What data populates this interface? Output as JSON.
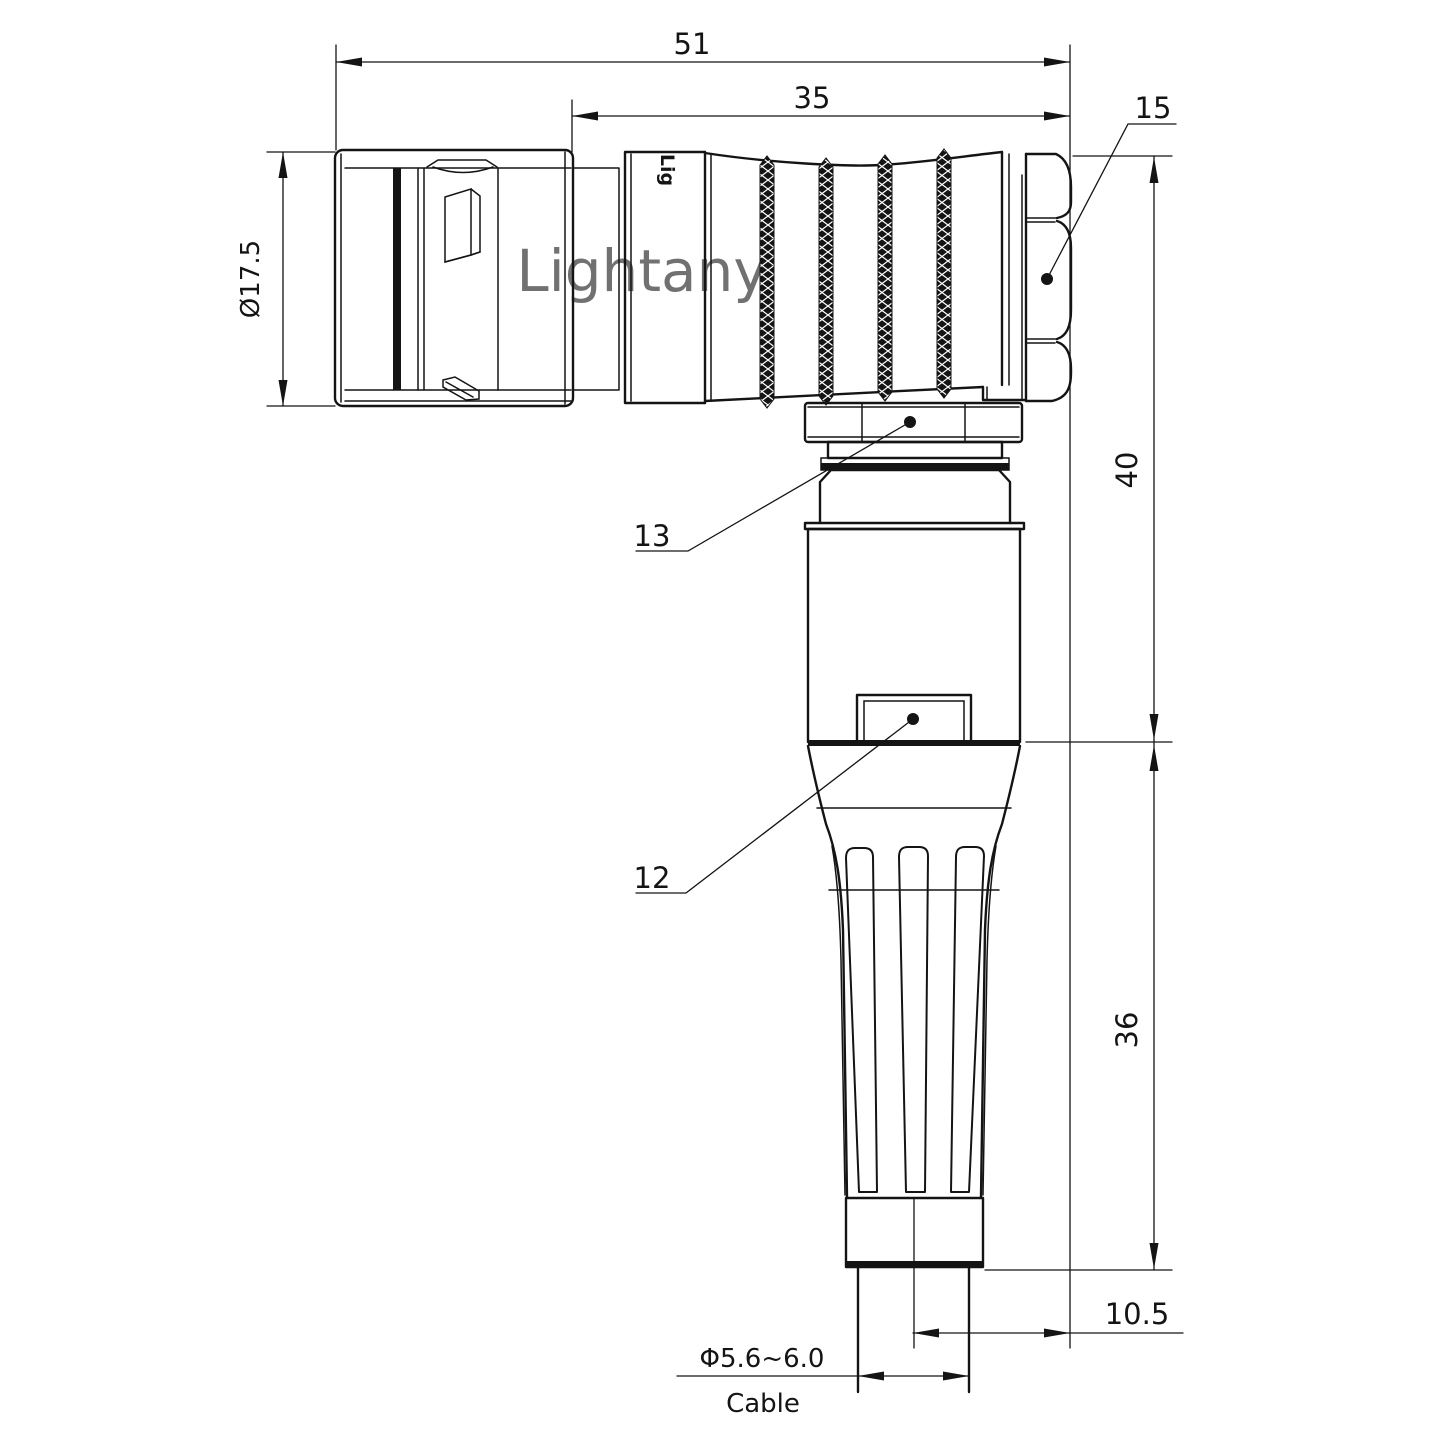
{
  "drawing": {
    "watermark": "Lightany",
    "shell_engraving": "Lig",
    "dimensions": {
      "overall_length": "51",
      "rear_length": "35",
      "shell_diameter": "Ø17.5",
      "upper_height": "40",
      "lower_height": "36",
      "cable_axis_offset": "10.5",
      "cable_diameter": "Φ5.6~6.0",
      "cable_label": "Cable"
    },
    "callouts": {
      "hex_nut": "15",
      "coupling_ring": "13",
      "housing": "12"
    },
    "colors": {
      "line": "#141414",
      "watermark": "#edc6c6",
      "background": "#ffffff"
    }
  }
}
